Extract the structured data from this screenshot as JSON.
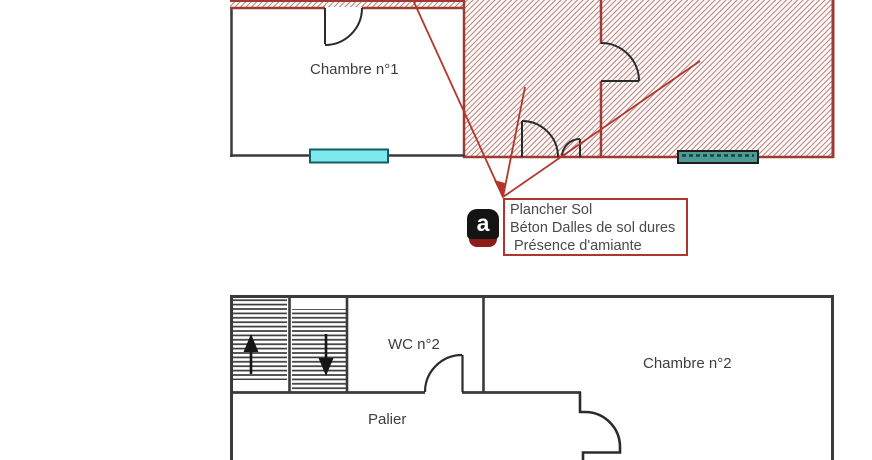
{
  "floor_plan_top": {
    "room1_label": "Chambre n°1"
  },
  "annotation": {
    "icon_letter": "a",
    "line1": "Plancher Sol",
    "line2": "Béton Dalles de sol dures",
    "line3": "Présence d'amiante"
  },
  "floor_plan_bottom": {
    "wc_label": "WC n°2",
    "palier_label": "Palier",
    "room2_label": "Chambre n°2"
  },
  "colors": {
    "wall_red": "#9e3a33",
    "leader_red": "#b3362c",
    "hatch_line": "#bc8b85",
    "wall_black": "#3a3a3a",
    "window_cyan": "#7ee9ed",
    "window_teal": "#4c9b96",
    "icon_black": "#141414",
    "icon_red": "#8c1c18"
  }
}
